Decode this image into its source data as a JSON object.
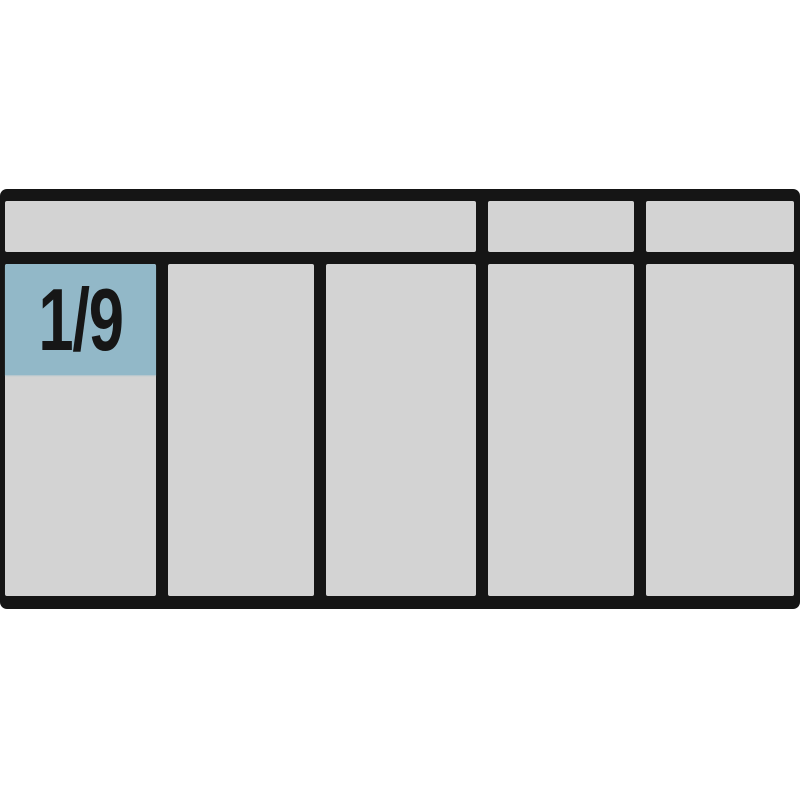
{
  "diagram": {
    "label": "1/9",
    "compartments": {
      "top_row_count": 3,
      "main_row_count": 5
    },
    "colors": {
      "background": "#ffffff",
      "outline": "#151515",
      "compartment_fill": "#d3d3d3",
      "label_fill": "#92b8c8",
      "label_text": "#161616"
    }
  }
}
